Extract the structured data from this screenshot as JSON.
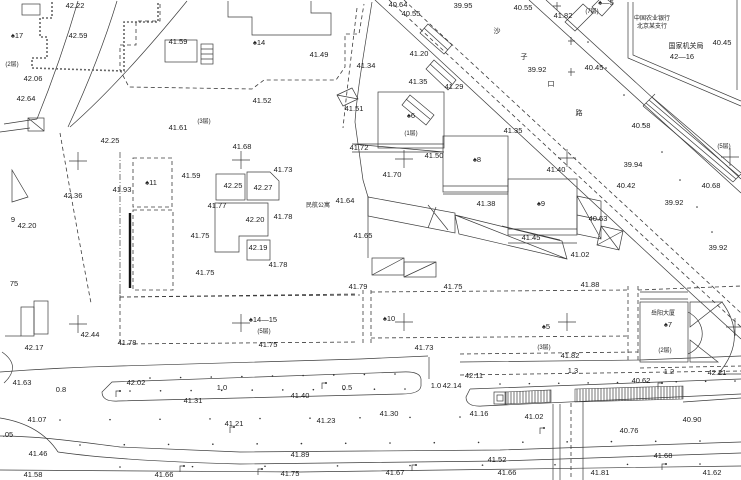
{
  "map": {
    "type": "topographic-survey-cad-drawing",
    "colors": {
      "paper": "#ffffff",
      "ink": "#1c1c1c",
      "line": "#3c3c3c"
    },
    "texts": {
      "street_name": "沙子口路",
      "bank_line1": "中国农业银行",
      "bank_line2": "北京某支行",
      "agency_line1": "国家机关局",
      "agency_line2": "42—16",
      "apartment": "民航公寓",
      "tower_name": "岳阳大厦",
      "tower_no": "♠7"
    },
    "labels": [
      {
        "t": "42.22",
        "x": 75,
        "y": 8
      },
      {
        "t": "40.64",
        "x": 398,
        "y": 7
      },
      {
        "t": "40.55",
        "x": 411,
        "y": 16
      },
      {
        "t": "39.95",
        "x": 463,
        "y": 8
      },
      {
        "t": "40.55",
        "x": 523,
        "y": 10
      },
      {
        "t": "41.82",
        "x": 563,
        "y": 18
      },
      {
        "t": "♠—5",
        "x": 606,
        "y": 5
      },
      {
        "t": "(7层)",
        "x": 592,
        "y": 13,
        "c": "sm"
      },
      {
        "t": "中国农业银行",
        "x": 652,
        "y": 20,
        "c": "sm"
      },
      {
        "t": "北京某支行",
        "x": 652,
        "y": 28,
        "c": "sm"
      },
      {
        "t": "国家机关局",
        "x": 686,
        "y": 48,
        "c": "cn"
      },
      {
        "t": "42—16",
        "x": 682,
        "y": 59
      },
      {
        "t": "40.45",
        "x": 722,
        "y": 45
      },
      {
        "t": "40.45",
        "x": 594,
        "y": 70
      },
      {
        "t": "39.92",
        "x": 537,
        "y": 72
      },
      {
        "t": "♠17",
        "x": 17,
        "y": 38
      },
      {
        "t": "42.59",
        "x": 78,
        "y": 38
      },
      {
        "t": "41.59",
        "x": 178,
        "y": 44
      },
      {
        "t": "♠14",
        "x": 259,
        "y": 45
      },
      {
        "t": "(2层)",
        "x": 12,
        "y": 66,
        "c": "sm"
      },
      {
        "t": "42.06",
        "x": 33,
        "y": 81
      },
      {
        "t": "42.64",
        "x": 26,
        "y": 101
      },
      {
        "t": "41.52",
        "x": 262,
        "y": 103
      },
      {
        "t": "41.49",
        "x": 319,
        "y": 57
      },
      {
        "t": "41.34",
        "x": 366,
        "y": 68
      },
      {
        "t": "41.51",
        "x": 354,
        "y": 111
      },
      {
        "t": "41.20",
        "x": 419,
        "y": 56
      },
      {
        "t": "41.35",
        "x": 418,
        "y": 84
      },
      {
        "t": "41.29",
        "x": 454,
        "y": 89
      },
      {
        "t": "41.61",
        "x": 178,
        "y": 130
      },
      {
        "t": "(3层)",
        "x": 204,
        "y": 123,
        "c": "sm"
      },
      {
        "t": "42.25",
        "x": 110,
        "y": 143
      },
      {
        "t": "41.35",
        "x": 513,
        "y": 133
      },
      {
        "t": "41.72",
        "x": 359,
        "y": 150
      },
      {
        "t": "(1层)",
        "x": 411,
        "y": 135,
        "c": "sm"
      },
      {
        "t": "41.50",
        "x": 434,
        "y": 158
      },
      {
        "t": "♠6",
        "x": 411,
        "y": 118
      },
      {
        "t": "♠8",
        "x": 477,
        "y": 162
      },
      {
        "t": "41.70",
        "x": 392,
        "y": 177
      },
      {
        "t": "41.40",
        "x": 556,
        "y": 172
      },
      {
        "t": "41.93",
        "x": 122,
        "y": 192
      },
      {
        "t": "♠11",
        "x": 151,
        "y": 185
      },
      {
        "t": "42.36",
        "x": 73,
        "y": 198
      },
      {
        "t": "41.59",
        "x": 191,
        "y": 178
      },
      {
        "t": "42.25",
        "x": 233,
        "y": 188
      },
      {
        "t": "42.27",
        "x": 263,
        "y": 190
      },
      {
        "t": "41.73",
        "x": 283,
        "y": 172
      },
      {
        "t": "41.68",
        "x": 242,
        "y": 149
      },
      {
        "t": "41.77",
        "x": 217,
        "y": 208
      },
      {
        "t": "42.20",
        "x": 255,
        "y": 222
      },
      {
        "t": "41.78",
        "x": 283,
        "y": 219
      },
      {
        "t": "41.64",
        "x": 345,
        "y": 203
      },
      {
        "t": "民航公寓",
        "x": 318,
        "y": 207,
        "c": "sm"
      },
      {
        "t": "41.38",
        "x": 486,
        "y": 206
      },
      {
        "t": "♠9",
        "x": 541,
        "y": 206
      },
      {
        "t": "41.45",
        "x": 531,
        "y": 240
      },
      {
        "t": "41.75",
        "x": 200,
        "y": 238
      },
      {
        "t": "42.19",
        "x": 258,
        "y": 250
      },
      {
        "t": "41.78",
        "x": 278,
        "y": 267
      },
      {
        "t": "41.75",
        "x": 205,
        "y": 275
      },
      {
        "t": "41.65",
        "x": 363,
        "y": 238
      },
      {
        "t": "40.58",
        "x": 641,
        "y": 128
      },
      {
        "t": "(5层)",
        "x": 724,
        "y": 148,
        "c": "sm"
      },
      {
        "t": "39.94",
        "x": 633,
        "y": 167
      },
      {
        "t": "40.42",
        "x": 626,
        "y": 188
      },
      {
        "t": "40.68",
        "x": 711,
        "y": 188
      },
      {
        "t": "39.92",
        "x": 674,
        "y": 205
      },
      {
        "t": "40.63",
        "x": 598,
        "y": 221
      },
      {
        "t": "39.92",
        "x": 718,
        "y": 250
      },
      {
        "t": "41.02",
        "x": 580,
        "y": 257
      },
      {
        "t": "41.88",
        "x": 590,
        "y": 287
      },
      {
        "t": "沙",
        "x": 497,
        "y": 33,
        "c": "cn"
      },
      {
        "t": "子",
        "x": 524,
        "y": 59,
        "c": "cn"
      },
      {
        "t": "口",
        "x": 551,
        "y": 86,
        "c": "cn"
      },
      {
        "t": "路",
        "x": 579,
        "y": 115,
        "c": "cn"
      },
      {
        "t": "41.79",
        "x": 358,
        "y": 289
      },
      {
        "t": "41.75",
        "x": 453,
        "y": 289
      },
      {
        "t": "♠14—15",
        "x": 263,
        "y": 322
      },
      {
        "t": "(5层)",
        "x": 264,
        "y": 333,
        "c": "sm"
      },
      {
        "t": "41.75",
        "x": 268,
        "y": 347
      },
      {
        "t": "♠10",
        "x": 389,
        "y": 321
      },
      {
        "t": "41.73",
        "x": 424,
        "y": 350
      },
      {
        "t": "♠5",
        "x": 546,
        "y": 329
      },
      {
        "t": "(3层)",
        "x": 544,
        "y": 349,
        "c": "sm"
      },
      {
        "t": "41.82",
        "x": 570,
        "y": 358
      },
      {
        "t": "岳阳大厦",
        "x": 663,
        "y": 315,
        "c": "sm"
      },
      {
        "t": "♠7",
        "x": 668,
        "y": 327
      },
      {
        "t": "(2层)",
        "x": 665,
        "y": 352,
        "c": "sm"
      },
      {
        "t": "41.78",
        "x": 127,
        "y": 345
      },
      {
        "t": "42.44",
        "x": 90,
        "y": 337
      },
      {
        "t": "42.17",
        "x": 34,
        "y": 350
      },
      {
        "t": "42.20",
        "x": 27,
        "y": 228
      },
      {
        "t": "9",
        "x": 13,
        "y": 222
      },
      {
        "t": "75",
        "x": 14,
        "y": 286
      },
      {
        "t": "41.63",
        "x": 22,
        "y": 385
      },
      {
        "t": "42.02",
        "x": 136,
        "y": 385
      },
      {
        "t": "0.8",
        "x": 61,
        "y": 392
      },
      {
        "t": "1.0",
        "x": 222,
        "y": 390
      },
      {
        "t": "41.31",
        "x": 193,
        "y": 403
      },
      {
        "t": "0.5",
        "x": 347,
        "y": 390
      },
      {
        "t": "41.40",
        "x": 300,
        "y": 398
      },
      {
        "t": "42.11",
        "x": 474,
        "y": 378
      },
      {
        "t": "1.0",
        "x": 436,
        "y": 388
      },
      {
        "t": "42.14",
        "x": 452,
        "y": 388
      },
      {
        "t": "1.3",
        "x": 573,
        "y": 373
      },
      {
        "t": "1.2",
        "x": 669,
        "y": 374
      },
      {
        "t": "40.62",
        "x": 641,
        "y": 383
      },
      {
        "t": "42.21",
        "x": 717,
        "y": 375
      },
      {
        "t": "41.30",
        "x": 389,
        "y": 416
      },
      {
        "t": "41.16",
        "x": 479,
        "y": 416
      },
      {
        "t": "41.07",
        "x": 37,
        "y": 422
      },
      {
        "t": "41.21",
        "x": 234,
        "y": 426
      },
      {
        "t": "41.23",
        "x": 326,
        "y": 423
      },
      {
        "t": "41.02",
        "x": 534,
        "y": 419
      },
      {
        "t": "40.90",
        "x": 692,
        "y": 422
      },
      {
        "t": "40.76",
        "x": 629,
        "y": 433
      },
      {
        "t": ".05",
        "x": 8,
        "y": 437
      },
      {
        "t": "41.46",
        "x": 38,
        "y": 456
      },
      {
        "t": "41.89",
        "x": 300,
        "y": 457
      },
      {
        "t": "41.68",
        "x": 663,
        "y": 458
      },
      {
        "t": "41.52",
        "x": 497,
        "y": 462
      },
      {
        "t": "41.58",
        "x": 33,
        "y": 477
      },
      {
        "t": "41.66",
        "x": 164,
        "y": 477
      },
      {
        "t": "41.75",
        "x": 290,
        "y": 476
      },
      {
        "t": "41.67",
        "x": 395,
        "y": 475
      },
      {
        "t": "41.66",
        "x": 507,
        "y": 475
      },
      {
        "t": "41.81",
        "x": 600,
        "y": 475
      },
      {
        "t": "41.62",
        "x": 712,
        "y": 475
      }
    ]
  }
}
